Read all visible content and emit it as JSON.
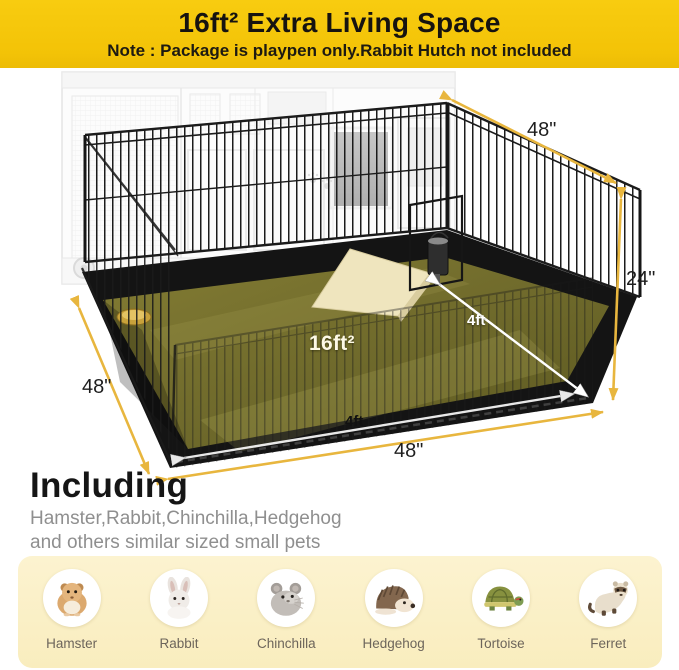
{
  "banner": {
    "title": "16ft² Extra Living Space",
    "note": "Note : Package is playpen only.Rabbit Hutch not included",
    "bg_color": "#F3C307",
    "text_color": "#1d1a12"
  },
  "scene": {
    "area_label": "16ft²",
    "dims": {
      "top_width": "48\"",
      "height": "24\"",
      "left_depth": "48\"",
      "front_width": "48\"",
      "mat_depth": "4ft",
      "mat_width": "4ft"
    },
    "colors": {
      "arrow_gold": "#E8B63E",
      "white_arrow": "#FFFFFF",
      "mat_olive": "#6E692D",
      "tray_black": "#141414",
      "ghost_gray": "#D9D9D9"
    }
  },
  "including": {
    "heading": "Including",
    "line1": "Hamster,Rabbit,Chinchilla,Hedgehog",
    "line2": "and others similar sized small pets"
  },
  "band": {
    "bg_color": "#FBF1CB"
  },
  "animals": [
    {
      "name": "Hamster"
    },
    {
      "name": "Rabbit"
    },
    {
      "name": "Chinchilla"
    },
    {
      "name": "Hedgehog"
    },
    {
      "name": "Tortoise"
    },
    {
      "name": "Ferret"
    }
  ]
}
